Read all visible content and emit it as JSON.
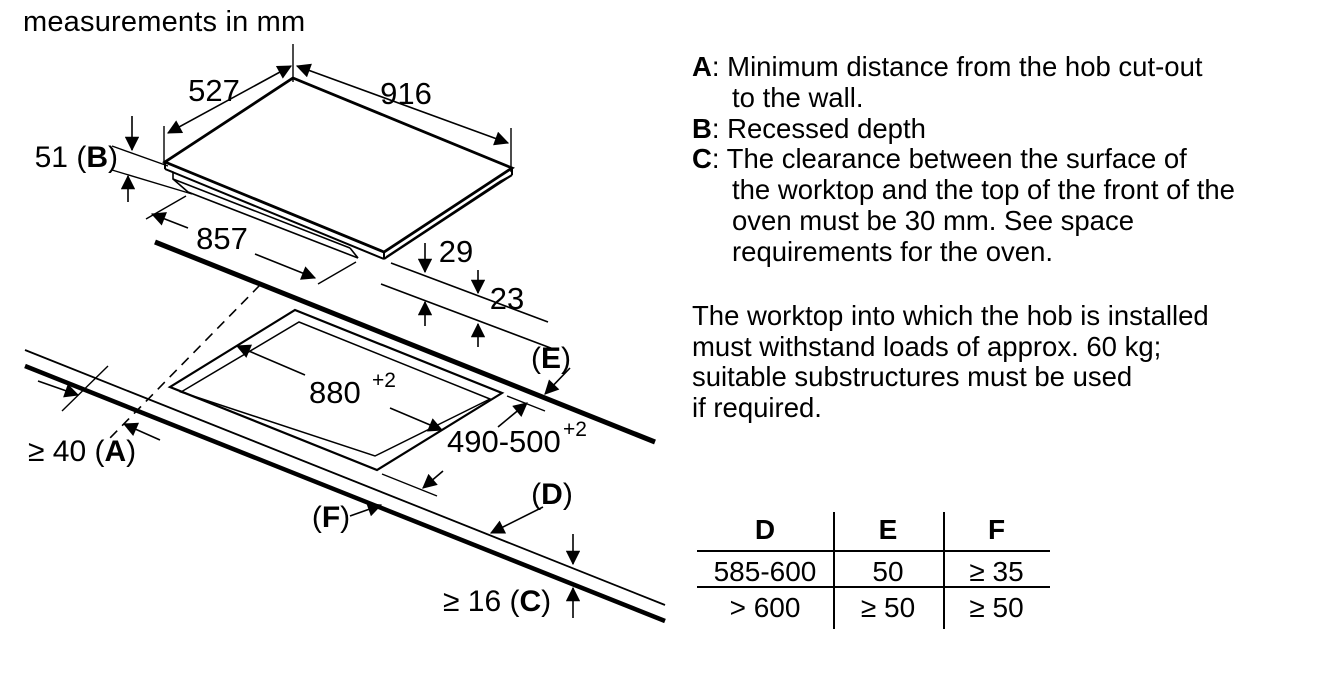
{
  "title": "measurements in mm",
  "diagram": {
    "dims": {
      "d527": "527",
      "d916": "916",
      "d857": "857",
      "d29": "29",
      "d23": "23",
      "d880_main": "880",
      "d880_sup": "+2",
      "d490_main": "490-500",
      "d490_sup": "+2",
      "d51_prefix": "51 (",
      "d51_letter": "B",
      "d51_suffix": ")",
      "d40_prefix": "≥ 40 (",
      "d40_letter": "A",
      "d40_suffix": ")",
      "d16_prefix": "≥ 16 (",
      "d16_letter": "C",
      "d16_suffix": ")",
      "e_prefix": "(",
      "e_letter": "E",
      "e_suffix": ")",
      "dd_prefix": "(",
      "dd_letter": "D",
      "dd_suffix": ")",
      "f_prefix": "(",
      "f_letter": "F",
      "f_suffix": ")"
    }
  },
  "definitions": [
    {
      "letter": "A",
      "sep": ": ",
      "lines": [
        "Minimum distance from the hob cut-out",
        "to the wall."
      ]
    },
    {
      "letter": "B",
      "sep": ": ",
      "lines": [
        "Recessed depth"
      ]
    },
    {
      "letter": "C",
      "sep": ": ",
      "lines": [
        "The clearance between the surface of",
        "the worktop and the top of the front of the",
        "oven must be 30 mm. See space",
        "requirements for the oven."
      ]
    }
  ],
  "note_lines": [
    "The worktop into which the hob is installed",
    "must withstand loads of approx. 60 kg;",
    "suitable substructures must be used",
    "if required."
  ],
  "table": {
    "headers": [
      "D",
      "E",
      "F"
    ],
    "rows": [
      [
        "585-600",
        "50",
        "≥ 35"
      ],
      [
        "> 600",
        "≥ 50",
        "≥ 50"
      ]
    ]
  },
  "colors": {
    "ink": "#000000",
    "background": "#ffffff"
  }
}
